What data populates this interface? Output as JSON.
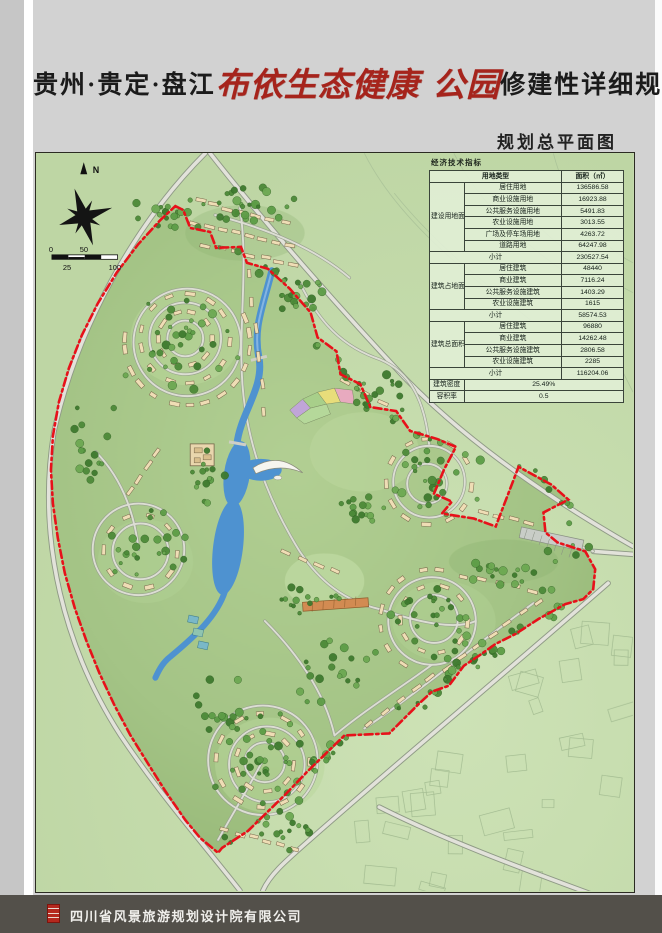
{
  "header": {
    "title_prefix": "贵州·贵定·盘江",
    "title_calligraphy": "布依生态健康 公园",
    "title_suffix": "修建性详细规划",
    "subtitle": "规划总平面图"
  },
  "map": {
    "compass_north": "N",
    "scale": {
      "t0": "0",
      "t25": "25",
      "t50": "50",
      "t100": "100"
    }
  },
  "table": {
    "caption": "经济技术指标",
    "header": {
      "land_type": "用地类型",
      "area": "面积（㎡）"
    },
    "g1": {
      "label": "建设用地面积",
      "rows": [
        [
          "居住用地",
          "136586.58"
        ],
        [
          "商业设施用地",
          "16923.88"
        ],
        [
          "公共服务设施用地",
          "5491.83"
        ],
        [
          "农业设施用地",
          "3013.55"
        ],
        [
          "广场及停车场用地",
          "4263.72"
        ],
        [
          "道路用地",
          "64247.98"
        ]
      ],
      "subtotal_label": "小计",
      "subtotal": "230527.54"
    },
    "g2": {
      "label": "建筑占地面积",
      "rows": [
        [
          "居住建筑",
          "48440"
        ],
        [
          "商业建筑",
          "7116.24"
        ],
        [
          "公共服务设施建筑",
          "1403.29"
        ],
        [
          "农业设施建筑",
          "1615"
        ]
      ],
      "subtotal_label": "小计",
      "subtotal": "58574.53"
    },
    "g3": {
      "label": "建筑总面积",
      "rows": [
        [
          "居住建筑",
          "96880"
        ],
        [
          "商业建筑",
          "14262.48"
        ],
        [
          "公共服务设施建筑",
          "2806.58"
        ],
        [
          "农业设施建筑",
          "2285"
        ]
      ],
      "subtotal_label": "小计",
      "subtotal": "116204.06"
    },
    "density": {
      "label": "建筑密度",
      "value": "25.49%"
    },
    "far": {
      "label": "容积率",
      "value": "0.5"
    }
  },
  "footer": {
    "company": "四川省风景旅游规划设计院有限公司"
  },
  "colors": {
    "boundary_red": "#e7111a",
    "water_blue": "#4e92d0",
    "site_green": "#a8c78a",
    "building_tan": "#efddb5",
    "calligraphy_red": "#a6241c",
    "footer_gray": "#53504a"
  }
}
